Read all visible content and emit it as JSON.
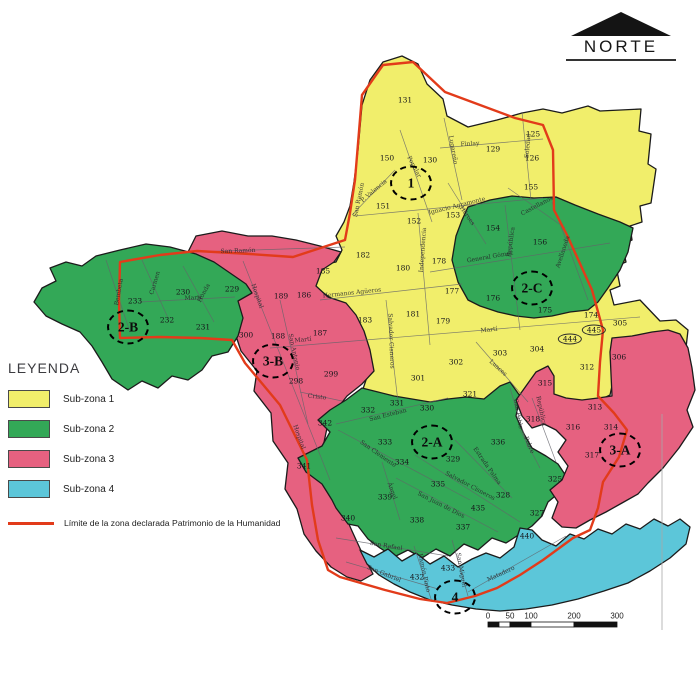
{
  "compass": {
    "label": "NORTE"
  },
  "legend": {
    "title": "LEYENDA",
    "items": [
      {
        "label": "Sub-zona 1",
        "color": "#f1ee6b"
      },
      {
        "label": "Sub-zona 2",
        "color": "#33a857"
      },
      {
        "label": "Sub-zona 3",
        "color": "#e66180"
      },
      {
        "label": "Sub-zona 4",
        "color": "#5cc6d9"
      }
    ],
    "boundary": {
      "label": "Límite de la zona declarada Patrimonio de la Humanidad",
      "color": "#e23b1a"
    }
  },
  "zones": [
    {
      "id": "1",
      "x": 411,
      "y": 183
    },
    {
      "id": "2-A",
      "x": 432,
      "y": 442
    },
    {
      "id": "2-B",
      "x": 128,
      "y": 327
    },
    {
      "id": "2-C",
      "x": 532,
      "y": 288
    },
    {
      "id": "3-A",
      "x": 620,
      "y": 450
    },
    {
      "id": "3-B",
      "x": 273,
      "y": 361
    },
    {
      "id": "4",
      "x": 455,
      "y": 597
    }
  ],
  "blocks": [
    {
      "n": "131",
      "x": 405,
      "y": 100
    },
    {
      "n": "150",
      "x": 387,
      "y": 158
    },
    {
      "n": "130",
      "x": 430,
      "y": 160
    },
    {
      "n": "129",
      "x": 493,
      "y": 149
    },
    {
      "n": "125",
      "x": 533,
      "y": 134
    },
    {
      "n": "126",
      "x": 532,
      "y": 158
    },
    {
      "n": "155",
      "x": 531,
      "y": 187
    },
    {
      "n": "151",
      "x": 383,
      "y": 206
    },
    {
      "n": "152",
      "x": 414,
      "y": 221
    },
    {
      "n": "153",
      "x": 453,
      "y": 215
    },
    {
      "n": "154",
      "x": 493,
      "y": 228
    },
    {
      "n": "156",
      "x": 540,
      "y": 242
    },
    {
      "n": "176",
      "x": 493,
      "y": 298
    },
    {
      "n": "175",
      "x": 545,
      "y": 310
    },
    {
      "n": "182",
      "x": 363,
      "y": 255
    },
    {
      "n": "185",
      "x": 323,
      "y": 271
    },
    {
      "n": "180",
      "x": 403,
      "y": 268
    },
    {
      "n": "178",
      "x": 439,
      "y": 261
    },
    {
      "n": "177",
      "x": 452,
      "y": 291
    },
    {
      "n": "183",
      "x": 365,
      "y": 320
    },
    {
      "n": "181",
      "x": 413,
      "y": 314
    },
    {
      "n": "179",
      "x": 443,
      "y": 321
    },
    {
      "n": "301",
      "x": 418,
      "y": 378
    },
    {
      "n": "302",
      "x": 456,
      "y": 362
    },
    {
      "n": "303",
      "x": 500,
      "y": 353
    },
    {
      "n": "304",
      "x": 537,
      "y": 349
    },
    {
      "n": "444",
      "x": 570,
      "y": 339,
      "oval": true
    },
    {
      "n": "445",
      "x": 594,
      "y": 330,
      "oval": true
    },
    {
      "n": "174",
      "x": 591,
      "y": 315
    },
    {
      "n": "305",
      "x": 620,
      "y": 323
    },
    {
      "n": "306",
      "x": 619,
      "y": 357
    },
    {
      "n": "312",
      "x": 587,
      "y": 367
    },
    {
      "n": "321",
      "x": 470,
      "y": 394
    },
    {
      "n": "229",
      "x": 232,
      "y": 289
    },
    {
      "n": "230",
      "x": 183,
      "y": 292
    },
    {
      "n": "233",
      "x": 135,
      "y": 301
    },
    {
      "n": "232",
      "x": 167,
      "y": 320
    },
    {
      "n": "231",
      "x": 203,
      "y": 327
    },
    {
      "n": "189",
      "x": 281,
      "y": 296
    },
    {
      "n": "186",
      "x": 304,
      "y": 295
    },
    {
      "n": "187",
      "x": 320,
      "y": 333
    },
    {
      "n": "188",
      "x": 278,
      "y": 336
    },
    {
      "n": "300",
      "x": 246,
      "y": 335
    },
    {
      "n": "299",
      "x": 331,
      "y": 374
    },
    {
      "n": "298",
      "x": 296,
      "y": 381
    },
    {
      "n": "315",
      "x": 545,
      "y": 383
    },
    {
      "n": "313",
      "x": 595,
      "y": 407
    },
    {
      "n": "318",
      "x": 533,
      "y": 419
    },
    {
      "n": "316",
      "x": 573,
      "y": 427
    },
    {
      "n": "314",
      "x": 611,
      "y": 427
    },
    {
      "n": "317",
      "x": 592,
      "y": 455
    },
    {
      "n": "332",
      "x": 368,
      "y": 410
    },
    {
      "n": "331",
      "x": 397,
      "y": 403
    },
    {
      "n": "330",
      "x": 427,
      "y": 408
    },
    {
      "n": "342",
      "x": 325,
      "y": 423
    },
    {
      "n": "333",
      "x": 385,
      "y": 442
    },
    {
      "n": "334",
      "x": 402,
      "y": 462
    },
    {
      "n": "329",
      "x": 453,
      "y": 459
    },
    {
      "n": "336",
      "x": 498,
      "y": 442
    },
    {
      "n": "335",
      "x": 438,
      "y": 484
    },
    {
      "n": "339",
      "x": 385,
      "y": 497
    },
    {
      "n": "328",
      "x": 503,
      "y": 495
    },
    {
      "n": "325",
      "x": 555,
      "y": 479
    },
    {
      "n": "435",
      "x": 478,
      "y": 508
    },
    {
      "n": "338",
      "x": 417,
      "y": 520
    },
    {
      "n": "337",
      "x": 463,
      "y": 527
    },
    {
      "n": "341",
      "x": 304,
      "y": 466
    },
    {
      "n": "340",
      "x": 348,
      "y": 518
    },
    {
      "n": "327",
      "x": 537,
      "y": 513
    },
    {
      "n": "432",
      "x": 417,
      "y": 577
    },
    {
      "n": "433",
      "x": 448,
      "y": 568
    },
    {
      "n": "440",
      "x": 527,
      "y": 536
    }
  ],
  "streets": [
    {
      "name": "P. Valencia",
      "x": 374,
      "y": 191,
      "angle": -40
    },
    {
      "name": "Popular",
      "x": 414,
      "y": 167,
      "angle": 62
    },
    {
      "name": "San Ramón",
      "x": 359,
      "y": 200,
      "angle": -78
    },
    {
      "name": "Finlay",
      "x": 470,
      "y": 144,
      "angle": -4
    },
    {
      "name": "Soledad",
      "x": 528,
      "y": 146,
      "angle": -85
    },
    {
      "name": "Ignacio Agramonte",
      "x": 457,
      "y": 206,
      "angle": -14
    },
    {
      "name": "Héroes",
      "x": 467,
      "y": 216,
      "angle": 55
    },
    {
      "name": "Castellanos",
      "x": 537,
      "y": 206,
      "angle": -28
    },
    {
      "name": "República",
      "x": 511,
      "y": 242,
      "angle": -82
    },
    {
      "name": "Avellaneda",
      "x": 563,
      "y": 252,
      "angle": -72
    },
    {
      "name": "General Gómez",
      "x": 490,
      "y": 257,
      "angle": -10
    },
    {
      "name": "Hermanos Agüeros",
      "x": 352,
      "y": 293,
      "angle": -6
    },
    {
      "name": "Independencia",
      "x": 423,
      "y": 250,
      "angle": -86
    },
    {
      "name": "San Ramón",
      "x": 238,
      "y": 251,
      "angle": -2
    },
    {
      "name": "Bembeta",
      "x": 119,
      "y": 292,
      "angle": -80
    },
    {
      "name": "Carmen",
      "x": 155,
      "y": 283,
      "angle": -74
    },
    {
      "name": "Honda",
      "x": 204,
      "y": 293,
      "angle": -62
    },
    {
      "name": "Martí",
      "x": 193,
      "y": 298,
      "angle": -3
    },
    {
      "name": "Martí",
      "x": 303,
      "y": 340,
      "angle": -6
    },
    {
      "name": "Martí",
      "x": 489,
      "y": 330,
      "angle": -6
    },
    {
      "name": "Hospital",
      "x": 257,
      "y": 296,
      "angle": 70
    },
    {
      "name": "Hospital",
      "x": 299,
      "y": 437,
      "angle": 70
    },
    {
      "name": "San Antonio",
      "x": 294,
      "y": 352,
      "angle": 78
    },
    {
      "name": "Luaces",
      "x": 498,
      "y": 368,
      "angle": 42
    },
    {
      "name": "Lugareño",
      "x": 453,
      "y": 150,
      "angle": 80
    },
    {
      "name": "Salvador Cisneros",
      "x": 391,
      "y": 341,
      "angle": 88
    },
    {
      "name": "Salvador Cisneros",
      "x": 470,
      "y": 486,
      "angle": 28
    },
    {
      "name": "San Clemente",
      "x": 378,
      "y": 454,
      "angle": 35
    },
    {
      "name": "San Esteban",
      "x": 388,
      "y": 415,
      "angle": -14
    },
    {
      "name": "San Juan de Dios",
      "x": 441,
      "y": 505,
      "angle": 27
    },
    {
      "name": "Estrada Palma",
      "x": 487,
      "y": 466,
      "angle": 55
    },
    {
      "name": "San Pablo",
      "x": 518,
      "y": 414,
      "angle": 80
    },
    {
      "name": "Pobre",
      "x": 529,
      "y": 445,
      "angle": 68
    },
    {
      "name": "República",
      "x": 541,
      "y": 411,
      "angle": 78
    },
    {
      "name": "San Rafael",
      "x": 386,
      "y": 546,
      "angle": 10
    },
    {
      "name": "Ángel",
      "x": 392,
      "y": 491,
      "angle": 70
    },
    {
      "name": "San Gabriel",
      "x": 384,
      "y": 574,
      "angle": 22
    },
    {
      "name": "Ramón Pinto",
      "x": 424,
      "y": 573,
      "angle": 78
    },
    {
      "name": "San Miguel",
      "x": 461,
      "y": 570,
      "angle": 80
    },
    {
      "name": "Matadero",
      "x": 501,
      "y": 574,
      "angle": -25
    },
    {
      "name": "Cristo",
      "x": 317,
      "y": 397,
      "angle": 6
    }
  ],
  "scalebar": {
    "labels": [
      "0",
      "50",
      "100",
      "200",
      "300"
    ]
  }
}
